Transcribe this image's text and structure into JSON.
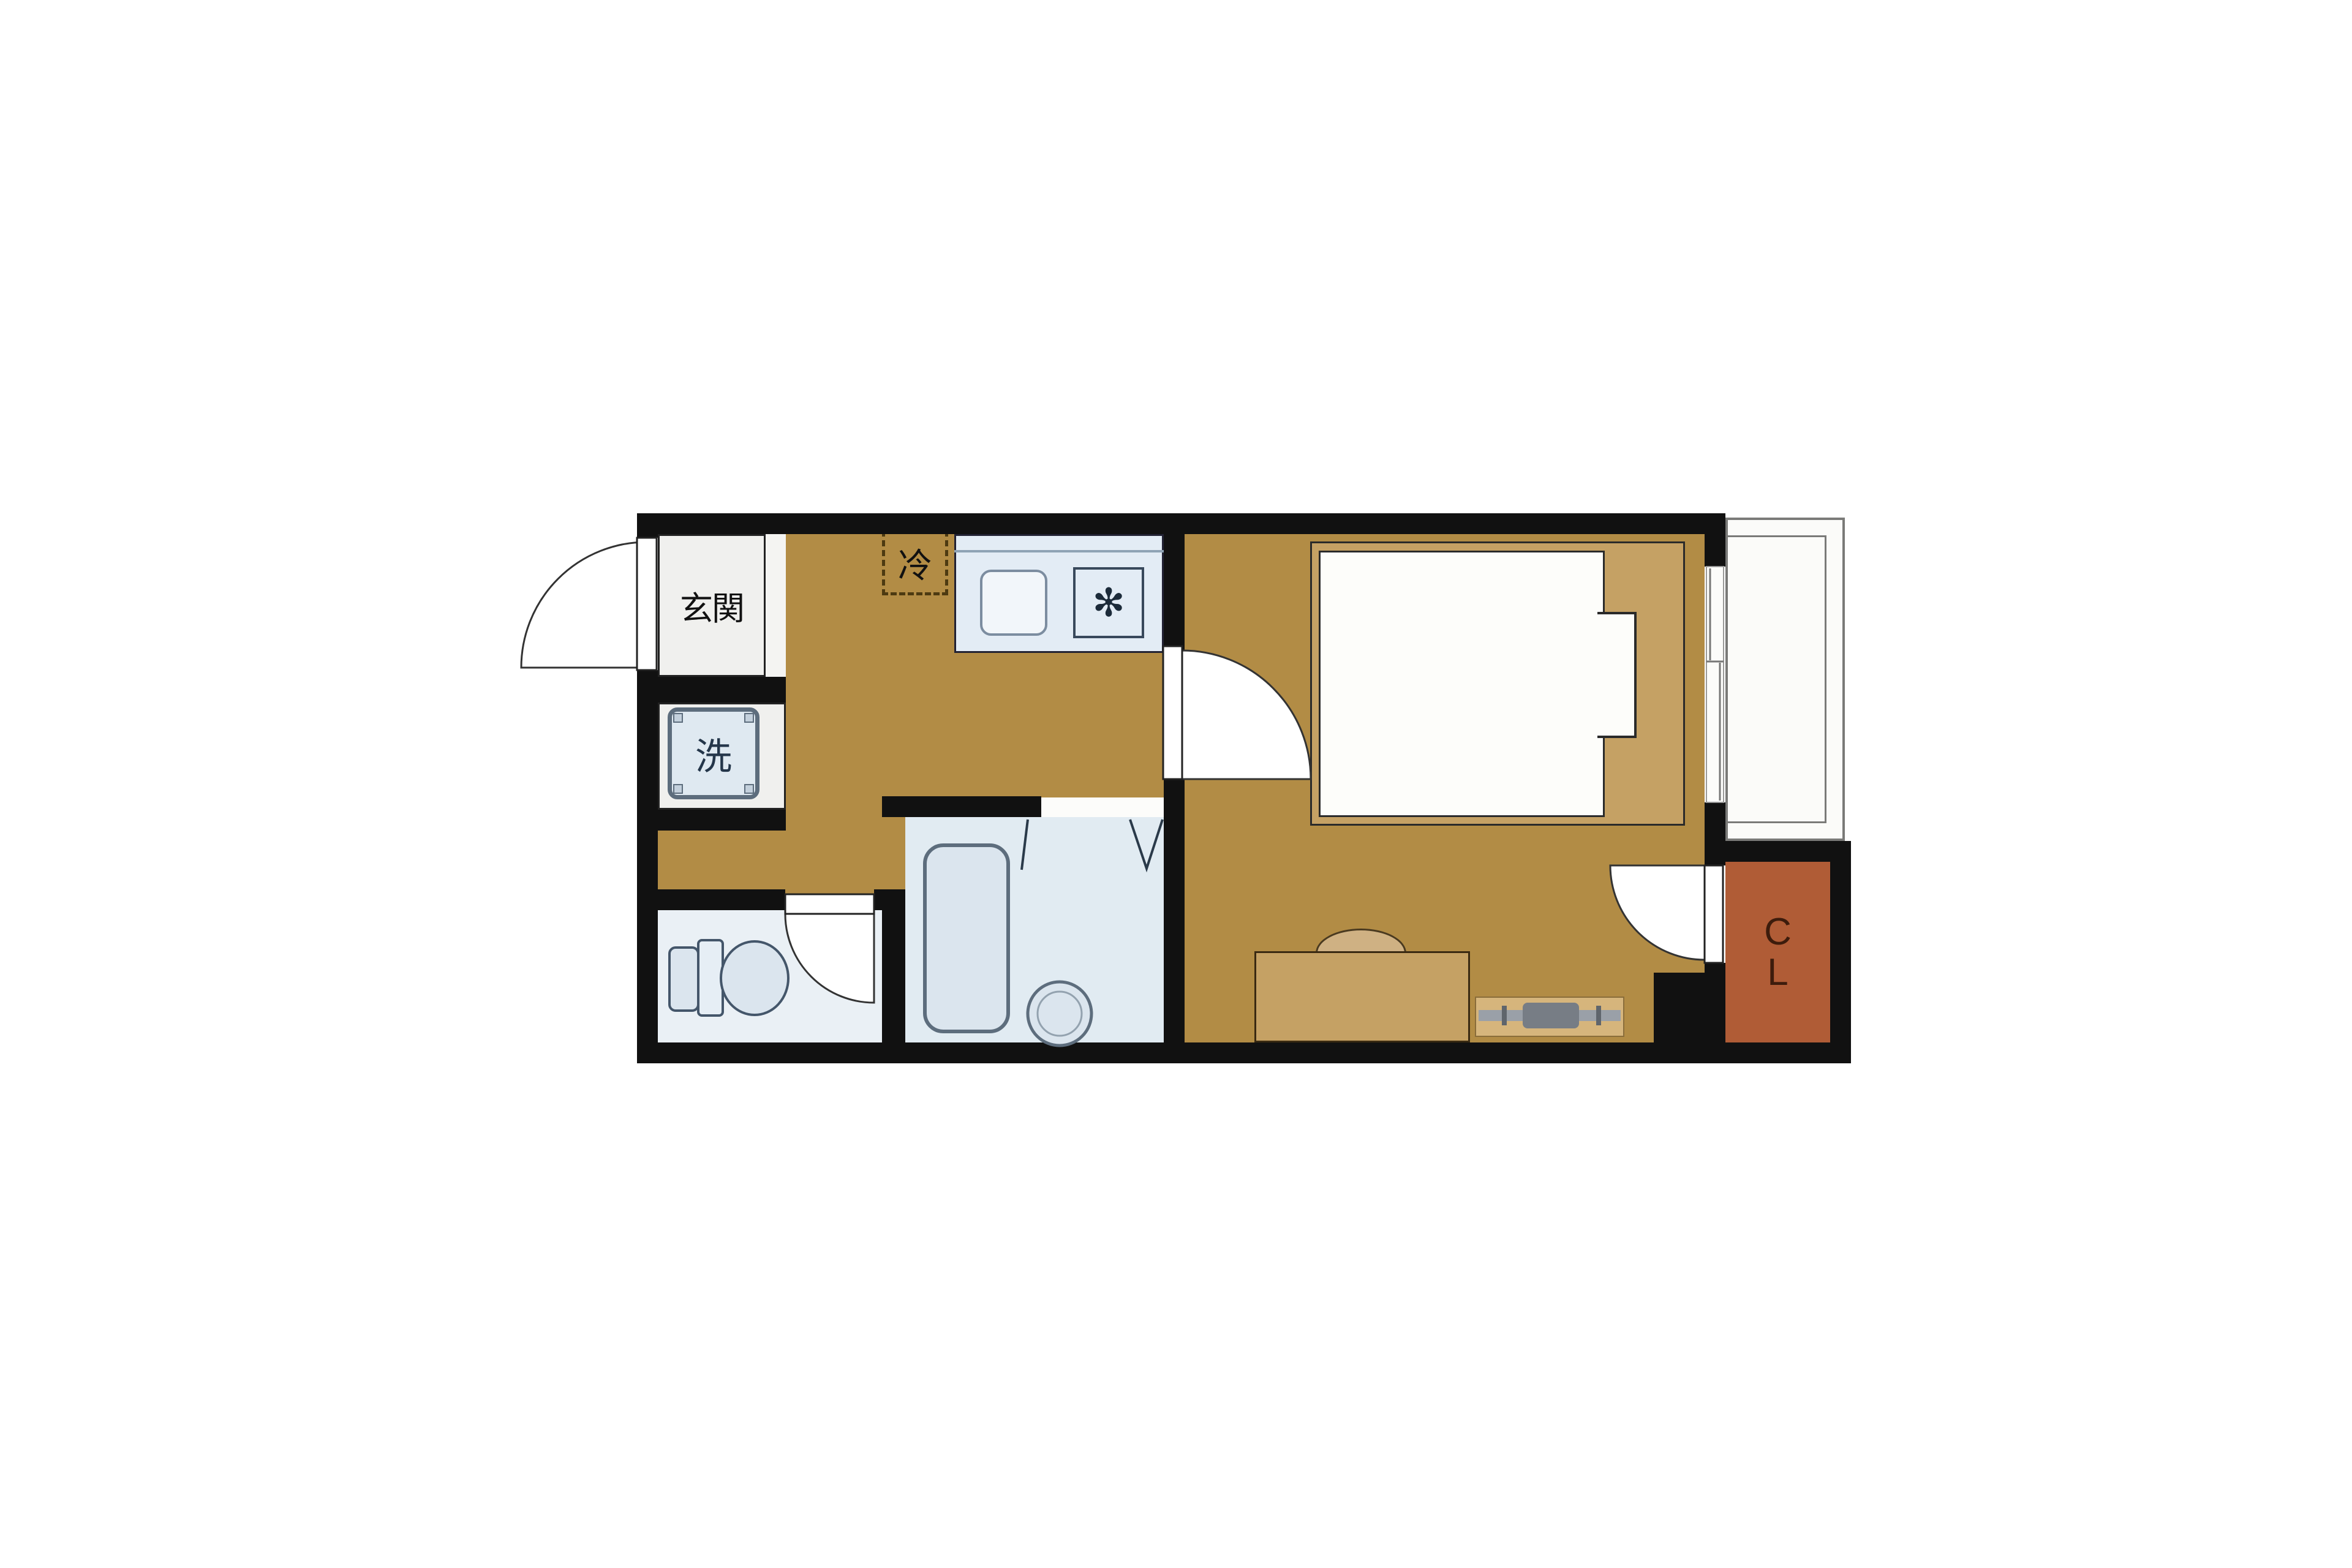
{
  "labels": {
    "entrance": "玄関",
    "washing_machine": "洗",
    "refrigerator": "冷",
    "closet_line1": "C",
    "closet_line2": "L",
    "stove_burner": "✻"
  },
  "colors": {
    "wall": "#111111",
    "floor_wood": "#b28c45",
    "furniture_tan": "#c5a164",
    "mat_tan": "#d6b57c",
    "entrance_tile": "#f0f0ee",
    "wet_room_floor": "#e1ebf2",
    "toilet_floor": "#eaf0f5",
    "fixture_fill": "#dbe5ee",
    "fixture_stroke": "#5d6d7d",
    "closet_fill": "#b05c36",
    "closet_text": "#3d1c0c",
    "balcony_line": "#7a7a78",
    "door_line": "#333333"
  }
}
